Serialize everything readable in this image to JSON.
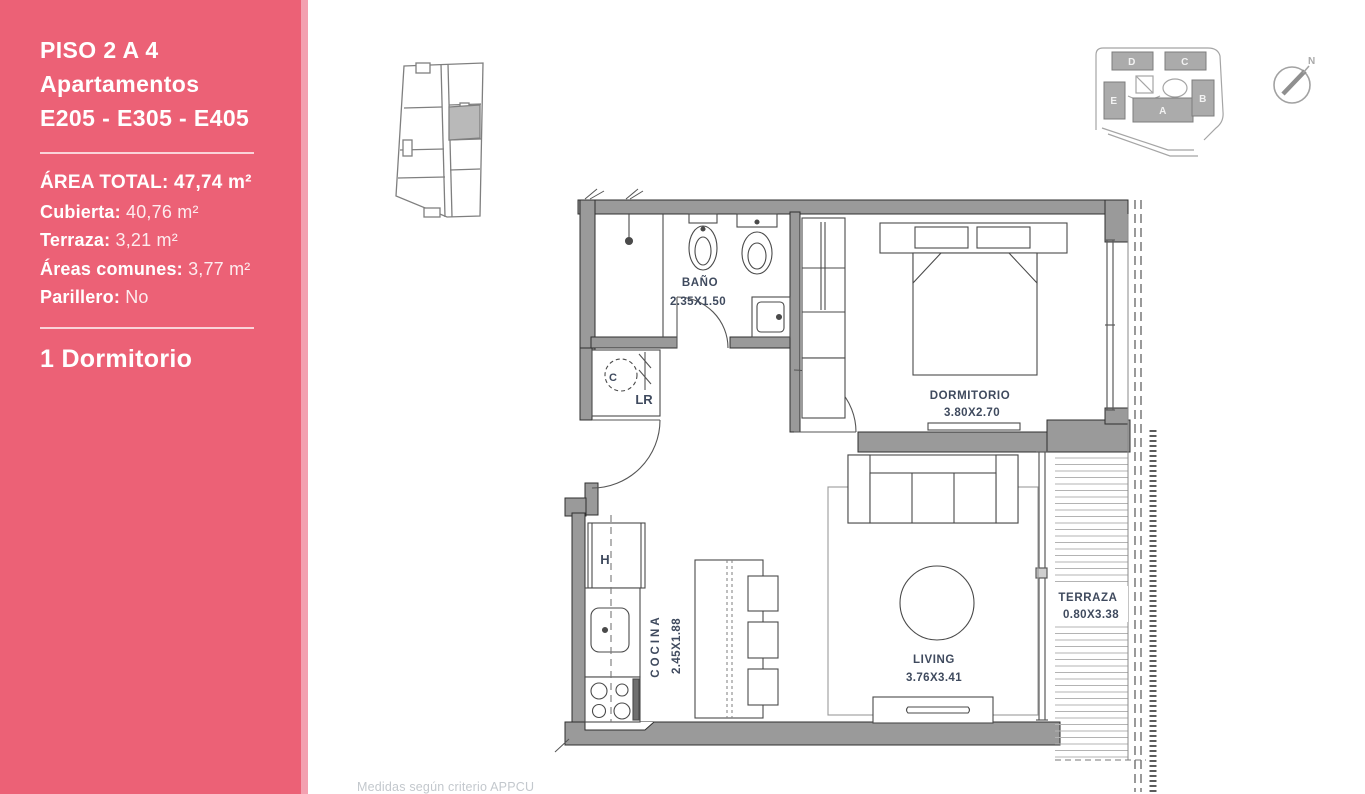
{
  "sidebar": {
    "background": "#ec6176",
    "edge_color": "#f3a0b0",
    "title_lines": [
      "PISO 2 A 4",
      "Apartamentos",
      "E205 - E305 - E405"
    ],
    "area_rows": [
      {
        "label": "ÁREA TOTAL:",
        "value": "47,74 m²"
      },
      {
        "label": "Cubierta:",
        "value": "40,76 m²"
      },
      {
        "label": "Terraza:",
        "value": "3,21 m²"
      },
      {
        "label": "Áreas comunes:",
        "value": "3,77 m²"
      },
      {
        "label": "Parillero:",
        "value": "No"
      }
    ],
    "unit_type": "1 Dormitorio"
  },
  "floor_plan": {
    "label_color": "#3f4a5e",
    "rooms": {
      "bathroom": {
        "name": "BAÑO",
        "dims": "2.35X1.50"
      },
      "bedroom": {
        "name": "DORMITORIO",
        "dims": "3.80X2.70"
      },
      "kitchen": {
        "name": "COCINA",
        "dims": "2.45X1.88"
      },
      "living": {
        "name": "LIVING",
        "dims": "3.76X3.41"
      },
      "terrace": {
        "name": "TERRAZA",
        "dims": "0.80X3.38"
      }
    },
    "annotations": {
      "heater": "C",
      "laundry": "LR",
      "fridge": "H"
    }
  },
  "site_plan": {
    "blocks": [
      "D",
      "C",
      "E",
      "A",
      "B"
    ]
  },
  "compass": {
    "north_label": "N"
  },
  "footer": {
    "note": "Medidas según criterio APPCU"
  }
}
